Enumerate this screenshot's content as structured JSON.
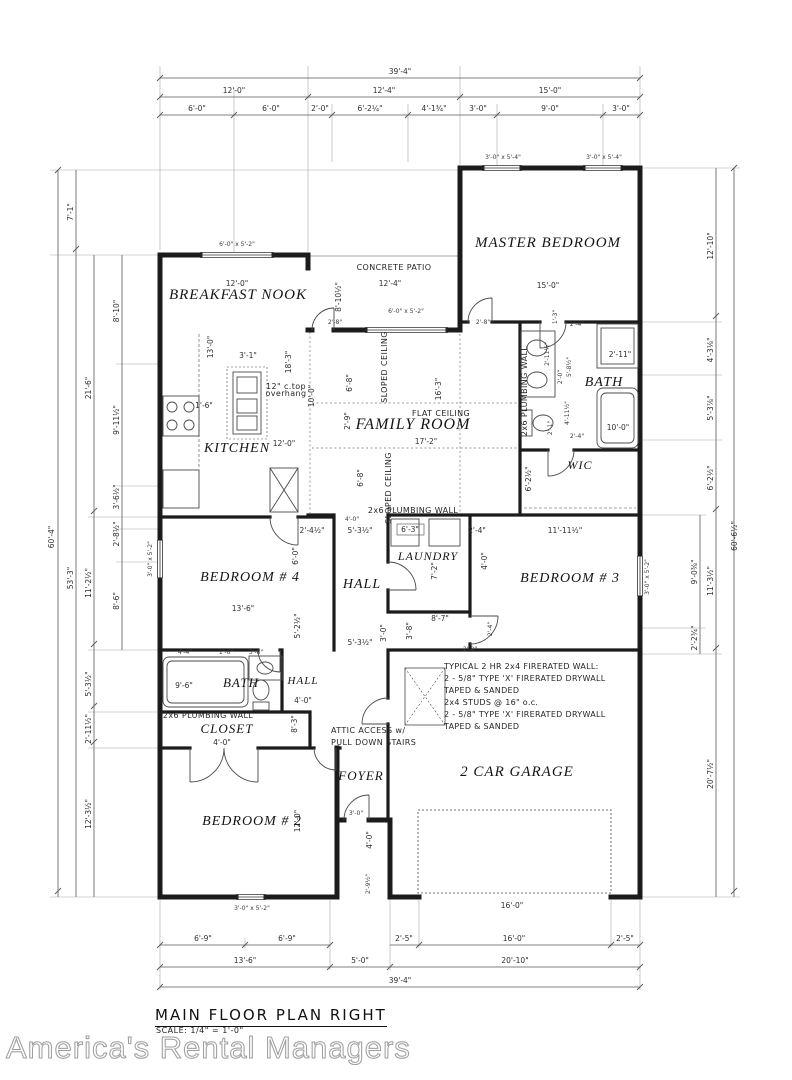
{
  "title_block": {
    "title": "MAIN FLOOR PLAN RIGHT",
    "scale": "SCALE: 1/4\" = 1'-0\""
  },
  "watermark": "America's Rental Managers",
  "colors": {
    "wall": "#1b1b1b",
    "dim_line": "#5a5a5a",
    "extension_line": "#9a9a9a",
    "text": "#2e2e2e",
    "watermark": "#9e9e9e"
  },
  "rooms": [
    "MASTER BEDROOM",
    "BREAKFAST NOOK",
    "KITCHEN",
    "FAMILY ROOM",
    "BATH",
    "WIC",
    "BEDROOM # 4",
    "HALL",
    "LAUNDRY",
    "BEDROOM # 3",
    "BATH",
    "HALL",
    "CLOSET",
    "FOYER",
    "BEDROOM # 2",
    "2 CAR GARAGE"
  ],
  "labels": [
    {
      "t": "MASTER BEDROOM",
      "x": 548,
      "y": 247,
      "c": "room",
      "fs": 15
    },
    {
      "t": "BREAKFAST NOOK",
      "x": 238,
      "y": 299,
      "c": "room",
      "fs": 15
    },
    {
      "t": "KITCHEN",
      "x": 237,
      "y": 452,
      "c": "room",
      "fs": 14
    },
    {
      "t": "FAMILY ROOM",
      "x": 413,
      "y": 429,
      "c": "room",
      "fs": 16
    },
    {
      "t": "BATH",
      "x": 604,
      "y": 386,
      "c": "room",
      "fs": 14
    },
    {
      "t": "WIC",
      "x": 580,
      "y": 469,
      "c": "room",
      "fs": 12
    },
    {
      "t": "BEDROOM # 4",
      "x": 250,
      "y": 581,
      "c": "room",
      "fs": 14
    },
    {
      "t": "HALL",
      "x": 362,
      "y": 588,
      "c": "room",
      "fs": 14
    },
    {
      "t": "LAUNDRY",
      "x": 428,
      "y": 560,
      "c": "room",
      "fs": 12
    },
    {
      "t": "BEDROOM # 3",
      "x": 570,
      "y": 582,
      "c": "room",
      "fs": 14
    },
    {
      "t": "BATH",
      "x": 241,
      "y": 687,
      "c": "room",
      "fs": 13
    },
    {
      "t": "HALL",
      "x": 303,
      "y": 684,
      "c": "room",
      "fs": 11
    },
    {
      "t": "CLOSET",
      "x": 227,
      "y": 733,
      "c": "room",
      "fs": 13
    },
    {
      "t": "FOYER",
      "x": 361,
      "y": 780,
      "c": "room",
      "fs": 13
    },
    {
      "t": "BEDROOM # 2",
      "x": 252,
      "y": 825,
      "c": "room",
      "fs": 14
    },
    {
      "t": "2 CAR GARAGE",
      "x": 517,
      "y": 776,
      "c": "room",
      "fs": 15
    },
    {
      "t": "39'-4\"",
      "x": 400,
      "y": 74,
      "c": "dim"
    },
    {
      "t": "12'-0\"",
      "x": 234,
      "y": 93,
      "c": "dim"
    },
    {
      "t": "12'-4\"",
      "x": 384,
      "y": 93,
      "c": "dim"
    },
    {
      "t": "15'-0\"",
      "x": 550,
      "y": 93,
      "c": "dim"
    },
    {
      "t": "6'-0\"",
      "x": 197,
      "y": 111,
      "c": "dim"
    },
    {
      "t": "6'-0\"",
      "x": 271,
      "y": 111,
      "c": "dim"
    },
    {
      "t": "2'-0\"",
      "x": 320,
      "y": 111,
      "c": "dim"
    },
    {
      "t": "6'-2¼\"",
      "x": 370,
      "y": 111,
      "c": "dim"
    },
    {
      "t": "4'-1¾\"",
      "x": 434,
      "y": 111,
      "c": "dim"
    },
    {
      "t": "3'-0\"",
      "x": 478,
      "y": 111,
      "c": "dim"
    },
    {
      "t": "9'-0\"",
      "x": 550,
      "y": 111,
      "c": "dim"
    },
    {
      "t": "3'-0\"",
      "x": 621,
      "y": 111,
      "c": "dim"
    },
    {
      "t": "60'-4\"",
      "x": 54,
      "y": 537,
      "c": "dim",
      "r": -90
    },
    {
      "t": "7'-1\"",
      "x": 73,
      "y": 212,
      "c": "dim",
      "r": -90
    },
    {
      "t": "53'-3\"",
      "x": 73,
      "y": 578,
      "c": "dim",
      "r": -90
    },
    {
      "t": "21'-6\"",
      "x": 91,
      "y": 388,
      "c": "dim",
      "r": -90
    },
    {
      "t": "11'-2½\"",
      "x": 91,
      "y": 583,
      "c": "dim",
      "r": -90
    },
    {
      "t": "5'-3½\"",
      "x": 91,
      "y": 684,
      "c": "dim",
      "r": -90
    },
    {
      "t": "2'-11½\"",
      "x": 91,
      "y": 729,
      "c": "dim",
      "r": -90
    },
    {
      "t": "12'-3½\"",
      "x": 91,
      "y": 814,
      "c": "dim",
      "r": -90
    },
    {
      "t": "8'-10\"",
      "x": 119,
      "y": 311,
      "c": "dim",
      "r": -90
    },
    {
      "t": "9'-11½\"",
      "x": 119,
      "y": 420,
      "c": "dim",
      "r": -90
    },
    {
      "t": "3'-6½\"",
      "x": 119,
      "y": 497,
      "c": "dim",
      "r": -90
    },
    {
      "t": "2'-8½\"",
      "x": 119,
      "y": 534,
      "c": "dim",
      "r": -90
    },
    {
      "t": "8'-6\"",
      "x": 119,
      "y": 601,
      "c": "dim",
      "r": -90
    },
    {
      "t": "60'-6½\"",
      "x": 737,
      "y": 536,
      "c": "dim",
      "r": -90
    },
    {
      "t": "12'-10\"",
      "x": 713,
      "y": 246,
      "c": "dim",
      "r": -90
    },
    {
      "t": "4'-3⅛\"",
      "x": 713,
      "y": 350,
      "c": "dim",
      "r": -90
    },
    {
      "t": "5'-3⅞\"",
      "x": 713,
      "y": 408,
      "c": "dim",
      "r": -90
    },
    {
      "t": "6'-2½\"",
      "x": 713,
      "y": 478,
      "c": "dim",
      "r": -90
    },
    {
      "t": "11'-3½\"",
      "x": 713,
      "y": 581,
      "c": "dim",
      "r": -90
    },
    {
      "t": "9'-0⅜\"",
      "x": 697,
      "y": 572,
      "c": "dim",
      "r": -90
    },
    {
      "t": "2'-2¾\"",
      "x": 697,
      "y": 638,
      "c": "dim",
      "r": -90
    },
    {
      "t": "20'-7½\"",
      "x": 713,
      "y": 774,
      "c": "dim",
      "r": -90
    },
    {
      "t": "6'-9\"",
      "x": 203,
      "y": 941,
      "c": "dim"
    },
    {
      "t": "6'-9\"",
      "x": 287,
      "y": 941,
      "c": "dim"
    },
    {
      "t": "2'-5\"",
      "x": 404,
      "y": 941,
      "c": "dim"
    },
    {
      "t": "16'-0\"",
      "x": 514,
      "y": 941,
      "c": "dim"
    },
    {
      "t": "2'-5\"",
      "x": 625,
      "y": 941,
      "c": "dim"
    },
    {
      "t": "13'-6\"",
      "x": 245,
      "y": 963,
      "c": "dim"
    },
    {
      "t": "5'-0\"",
      "x": 360,
      "y": 963,
      "c": "dim"
    },
    {
      "t": "20'-10\"",
      "x": 515,
      "y": 963,
      "c": "dim"
    },
    {
      "t": "39'-4\"",
      "x": 400,
      "y": 983,
      "c": "dim"
    },
    {
      "t": "15'-0\"",
      "x": 548,
      "y": 288,
      "c": "dim",
      "fs": 7
    },
    {
      "t": "12'-0\"",
      "x": 237,
      "y": 286,
      "c": "dim",
      "fs": 7
    },
    {
      "t": "13'-0\"",
      "x": 213,
      "y": 347,
      "c": "dim",
      "fs": 7,
      "r": -90
    },
    {
      "t": "12'-4\"",
      "x": 390,
      "y": 286,
      "c": "dim",
      "fs": 7
    },
    {
      "t": "8'-10½\"",
      "x": 341,
      "y": 297,
      "c": "dim",
      "fs": 6.5,
      "r": -90
    },
    {
      "t": "2'-8\"",
      "x": 335,
      "y": 324,
      "c": "tiny"
    },
    {
      "t": "2'-8\"",
      "x": 483,
      "y": 324,
      "c": "tiny"
    },
    {
      "t": "3'-1\"",
      "x": 248,
      "y": 358,
      "c": "dim",
      "fs": 6.5
    },
    {
      "t": "1'-6\"",
      "x": 204,
      "y": 408,
      "c": "dim",
      "fs": 6.5
    },
    {
      "t": "18'-3\"",
      "x": 291,
      "y": 362,
      "c": "dim",
      "fs": 7,
      "r": -90
    },
    {
      "t": "12'-0\"",
      "x": 284,
      "y": 446,
      "c": "dim",
      "fs": 7
    },
    {
      "t": "10'-0\"",
      "x": 314,
      "y": 396,
      "c": "dim",
      "fs": 7,
      "r": -90
    },
    {
      "t": "16'-3\"",
      "x": 441,
      "y": 389,
      "c": "dim",
      "fs": 7,
      "r": -90
    },
    {
      "t": "6'-8\"",
      "x": 352,
      "y": 383,
      "c": "dim",
      "fs": 7,
      "r": -90
    },
    {
      "t": "2'-9\"",
      "x": 350,
      "y": 421,
      "c": "dim",
      "fs": 6.5,
      "r": -90
    },
    {
      "t": "17'-2\"",
      "x": 426,
      "y": 444,
      "c": "dim",
      "fs": 7
    },
    {
      "t": "6'-8\"",
      "x": 363,
      "y": 478,
      "c": "dim",
      "fs": 7,
      "r": -90
    },
    {
      "t": "1'-3\"",
      "x": 557,
      "y": 317,
      "c": "tiny",
      "r": -90
    },
    {
      "t": "2'-4\"",
      "x": 577,
      "y": 326,
      "c": "tiny"
    },
    {
      "t": "2'-11½\"",
      "x": 549,
      "y": 354,
      "c": "tiny",
      "r": -90
    },
    {
      "t": "2'-0\"",
      "x": 562,
      "y": 377,
      "c": "tiny",
      "r": -90
    },
    {
      "t": "5'-8½\"",
      "x": 571,
      "y": 367,
      "c": "tiny",
      "r": -90
    },
    {
      "t": "2'-11\"",
      "x": 620,
      "y": 357,
      "c": "dim",
      "fs": 6.5
    },
    {
      "t": "4'-11½\"",
      "x": 569,
      "y": 413,
      "c": "tiny",
      "r": -90
    },
    {
      "t": "2'-1\"",
      "x": 552,
      "y": 428,
      "c": "tiny",
      "r": -90
    },
    {
      "t": "10'-0\"",
      "x": 618,
      "y": 430,
      "c": "dim",
      "fs": 7
    },
    {
      "t": "6'-2½\"",
      "x": 531,
      "y": 479,
      "c": "dim",
      "fs": 6.5,
      "r": -90
    },
    {
      "t": "2'-4\"",
      "x": 577,
      "y": 438,
      "c": "tiny"
    },
    {
      "t": "2'-4½\"",
      "x": 312,
      "y": 533,
      "c": "dim",
      "fs": 6.5
    },
    {
      "t": "4'-0\"",
      "x": 352,
      "y": 521,
      "c": "tiny"
    },
    {
      "t": "5'-3½\"",
      "x": 360,
      "y": 533,
      "c": "dim",
      "fs": 7
    },
    {
      "t": "5'-3½\"",
      "x": 360,
      "y": 645,
      "c": "dim",
      "fs": 7
    },
    {
      "t": "6'-0\"",
      "x": 298,
      "y": 556,
      "c": "dim",
      "fs": 6.5,
      "r": -90
    },
    {
      "t": "13'-6\"",
      "x": 243,
      "y": 611,
      "c": "dim",
      "fs": 7
    },
    {
      "t": "5'-2½\"",
      "x": 300,
      "y": 626,
      "c": "dim",
      "fs": 6.5,
      "r": -90
    },
    {
      "t": "4'-4\"",
      "x": 185,
      "y": 654,
      "c": "tiny"
    },
    {
      "t": "1'-6\"",
      "x": 226,
      "y": 654,
      "c": "tiny"
    },
    {
      "t": "3'-8\"",
      "x": 256,
      "y": 654,
      "c": "tiny"
    },
    {
      "t": "9'-6\"",
      "x": 184,
      "y": 688,
      "c": "dim",
      "fs": 7
    },
    {
      "t": "4'-0\"",
      "x": 222,
      "y": 745,
      "c": "dim",
      "fs": 6.5
    },
    {
      "t": "4'-0\"",
      "x": 303,
      "y": 703,
      "c": "dim",
      "fs": 7
    },
    {
      "t": "8'-3\"",
      "x": 297,
      "y": 724,
      "c": "dim",
      "fs": 6.5,
      "r": -90
    },
    {
      "t": "6'-3\"",
      "x": 410,
      "y": 532,
      "c": "dim",
      "fs": 7
    },
    {
      "t": "7'-2\"",
      "x": 437,
      "y": 571,
      "c": "dim",
      "fs": 6.5,
      "r": -90
    },
    {
      "t": "2'-4\"",
      "x": 477,
      "y": 533,
      "c": "dim",
      "fs": 6.5
    },
    {
      "t": "4'-0\"",
      "x": 487,
      "y": 561,
      "c": "dim",
      "fs": 6.5,
      "r": -90
    },
    {
      "t": "11'-11½\"",
      "x": 565,
      "y": 533,
      "c": "dim",
      "fs": 7
    },
    {
      "t": "8'-7\"",
      "x": 440,
      "y": 621,
      "c": "dim",
      "fs": 7
    },
    {
      "t": "3'-8\"",
      "x": 412,
      "y": 631,
      "c": "dim",
      "fs": 6.5,
      "r": -90
    },
    {
      "t": "3'-0\"",
      "x": 386,
      "y": 633,
      "c": "dim",
      "fs": 6.5,
      "r": -90
    },
    {
      "t": "2'-4\"",
      "x": 492,
      "y": 629,
      "c": "tiny",
      "r": -90
    },
    {
      "t": "2'-8\"",
      "x": 470,
      "y": 651,
      "c": "tiny"
    },
    {
      "t": "12'-0\"",
      "x": 300,
      "y": 821,
      "c": "dim",
      "fs": 7,
      "r": -90
    },
    {
      "t": "3'-0\"",
      "x": 356,
      "y": 815,
      "c": "tiny"
    },
    {
      "t": "4'-0\"",
      "x": 372,
      "y": 840,
      "c": "dim",
      "fs": 6.5,
      "r": -90
    },
    {
      "t": "2'-9½\"",
      "x": 370,
      "y": 884,
      "c": "tiny",
      "r": -90
    },
    {
      "t": "16'-0\"",
      "x": 512,
      "y": 908,
      "c": "dim",
      "fs": 6.5
    },
    {
      "t": "3'-0\" x 5'-4\"",
      "x": 503,
      "y": 159,
      "c": "tiny"
    },
    {
      "t": "3'-0\" x 5'-4\"",
      "x": 604,
      "y": 159,
      "c": "tiny"
    },
    {
      "t": "6'-0\" x 5'-2\"",
      "x": 237,
      "y": 246,
      "c": "tiny"
    },
    {
      "t": "6'-0\" x 5'-2\"",
      "x": 406,
      "y": 313,
      "c": "tiny"
    },
    {
      "t": "3'-0\" x 5'-2\"",
      "x": 152,
      "y": 559,
      "c": "tiny",
      "r": -90
    },
    {
      "t": "3'-0\" x 5'-2\"",
      "x": 649,
      "y": 577,
      "c": "tiny",
      "r": -90
    },
    {
      "t": "3'-0\" x 5'-2\"",
      "x": 252,
      "y": 910,
      "c": "tiny"
    },
    {
      "t": "CONCRETE PATIO",
      "x": 394,
      "y": 270,
      "c": "arch",
      "fs": 8.5
    },
    {
      "t": "FLAT CEILING",
      "x": 441,
      "y": 416,
      "c": "arch",
      "fs": 8
    },
    {
      "t": "SLOPED CEILING",
      "x": 387,
      "y": 367,
      "c": "arch",
      "fs": 8,
      "r": -90
    },
    {
      "t": "SLOPED CEILING",
      "x": 391,
      "y": 488,
      "c": "arch",
      "fs": 8,
      "r": -90
    },
    {
      "t": "2x6 PLUMBING WALL",
      "x": 527,
      "y": 391,
      "c": "arch",
      "fs": 7,
      "r": -90
    },
    {
      "t": "2x6 PLUMBING WALL",
      "x": 413,
      "y": 513,
      "c": "arch",
      "fs": 7
    },
    {
      "t": "2x6 PLUMBING WALL",
      "x": 208,
      "y": 718,
      "c": "arch",
      "fs": 7
    },
    {
      "t": "ATTIC ACCESS w/",
      "x": 331,
      "y": 733,
      "c": "arch",
      "fs": 8,
      "a": "start"
    },
    {
      "t": "PULL DOWN STAIRS",
      "x": 331,
      "y": 745,
      "c": "arch",
      "fs": 8,
      "a": "start"
    },
    {
      "t": "12\" c.top",
      "x": 286,
      "y": 389,
      "c": "arch",
      "fs": 5.5
    },
    {
      "t": "overhang",
      "x": 286,
      "y": 396,
      "c": "arch",
      "fs": 5.5
    },
    {
      "t": "TYPICAL 2 HR 2x4 FIRERATED WALL:",
      "x": 444,
      "y": 669,
      "c": "note",
      "a": "start"
    },
    {
      "t": "2 - 5/8\" TYPE 'X' FIRERATED DRYWALL",
      "x": 444,
      "y": 681,
      "c": "note",
      "a": "start"
    },
    {
      "t": "TAPED & SANDED",
      "x": 444,
      "y": 693,
      "c": "note",
      "a": "start"
    },
    {
      "t": "2x4 STUDS @ 16\" o.c.",
      "x": 444,
      "y": 705,
      "c": "note",
      "a": "start"
    },
    {
      "t": "2 - 5/8\" TYPE 'X' FIRERATED DRYWALL",
      "x": 444,
      "y": 717,
      "c": "note",
      "a": "start"
    },
    {
      "t": "TAPED & SANDED",
      "x": 444,
      "y": 729,
      "c": "note",
      "a": "start"
    }
  ]
}
